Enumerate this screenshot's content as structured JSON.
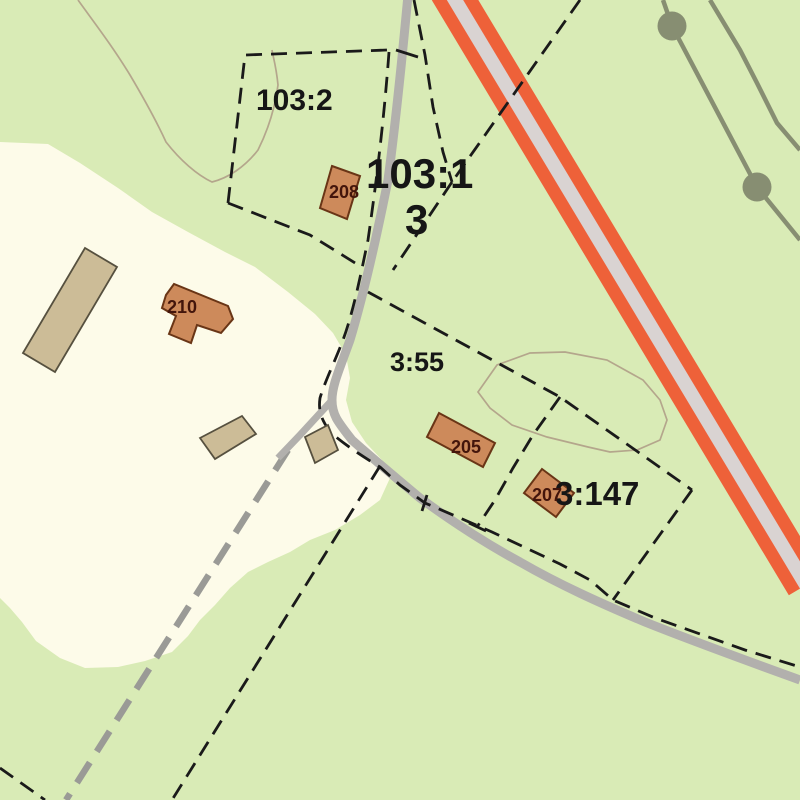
{
  "map": {
    "description": "cadastral property map",
    "labels": {
      "p103_2": "103:2",
      "p103_1": "103:1",
      "p3": "3",
      "p3_55": "3:55",
      "p3_147": "3:147",
      "b208": "208",
      "b210": "210",
      "b205": "205",
      "b207": "207"
    },
    "colors": {
      "land_green": "#d9ebb6",
      "field_cream": "#fdfbe9",
      "highway_red": "#ee6139",
      "highway_median": "#d9d3d2",
      "road_gray": "#b2b0ad",
      "trail_gray": "#9a9a96",
      "boundary_black": "#1a1a1a",
      "building_orange": "#cd8a5b",
      "building_orange_outline": "#693516",
      "building_tan": "#ccbc97",
      "building_tan_outline": "#56503f",
      "contour_brown": "#b4a68c",
      "powerline_olive": "#878e72",
      "building_number": "#43150b"
    },
    "features": [
      "open field area",
      "parcel boundaries (dashed)",
      "minor gravel road",
      "trail (dashed gray)",
      "major road (red cased)",
      "power line with pole markers",
      "vegetation contour outlines",
      "buildings 205, 207, 208, 210"
    ]
  }
}
